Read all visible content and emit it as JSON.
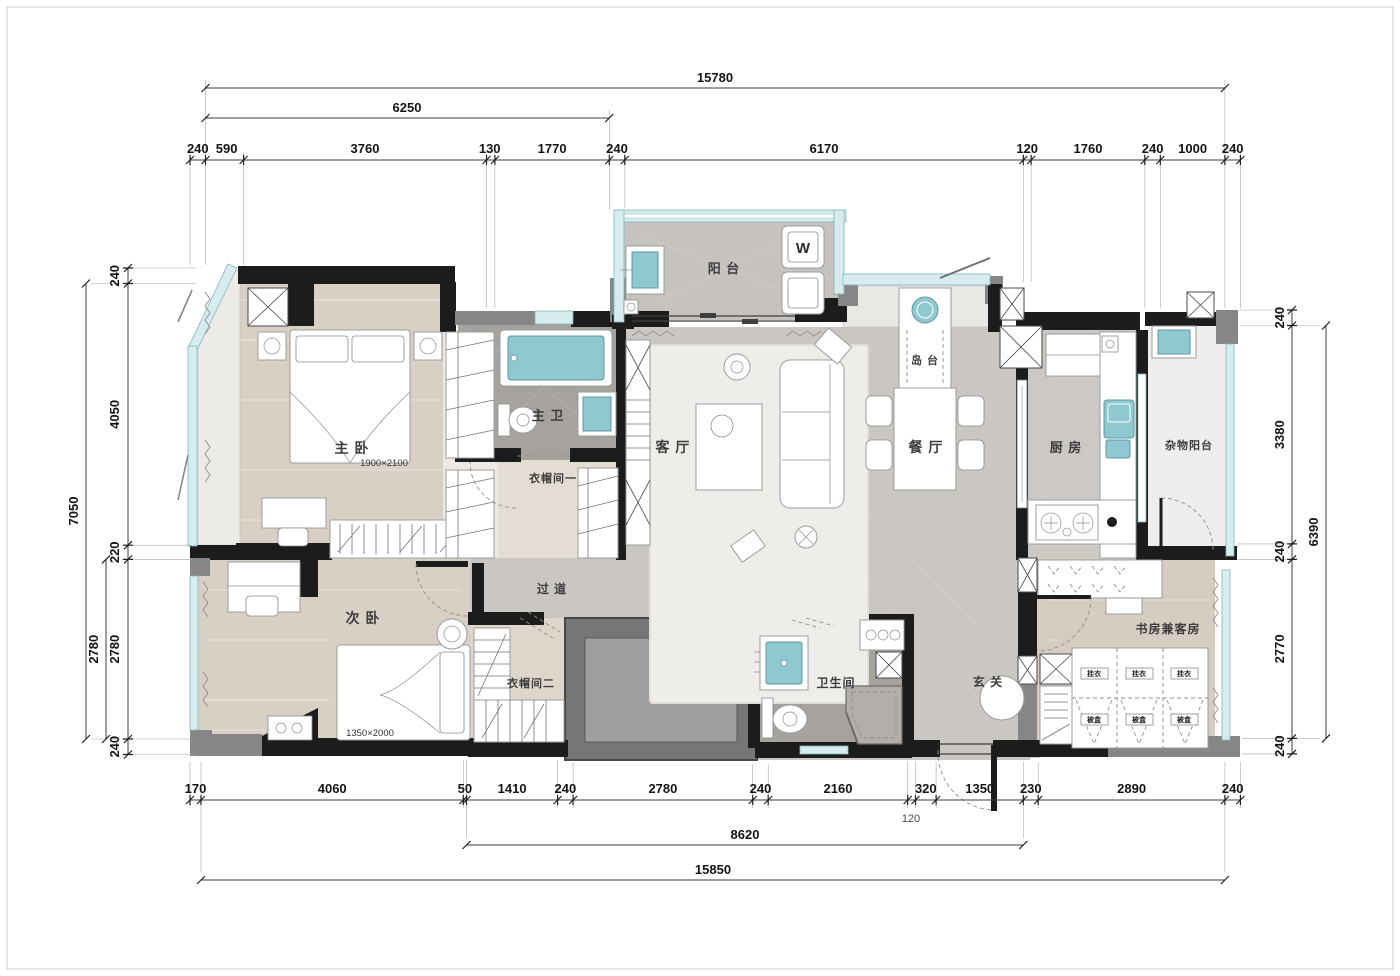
{
  "drawing": {
    "type": "apartment-floor-plan",
    "colors": {
      "wall_black": "#1c1c1c",
      "wall_gray": "#868686",
      "fixture_teal": "#8fc8d0",
      "glazing_teal": "#d7ecee",
      "wood_floor": "#d8cfc5",
      "marble_floor": "#cac6c1",
      "dark_marble_floor": "#a6a29d",
      "void_gray": "#767676"
    }
  },
  "rooms": {
    "master_bedroom": {
      "label": "主 卧",
      "bed_size": "1900×2100"
    },
    "second_bedroom": {
      "label": "次 卧",
      "bed_size": "1350×2000"
    },
    "master_bath": {
      "label": "主 卫"
    },
    "closet1": {
      "label": "衣帽间一"
    },
    "closet2": {
      "label": "衣帽间二"
    },
    "living": {
      "label": "客 厅"
    },
    "dining": {
      "label": "餐 厅"
    },
    "island": {
      "label": "岛 台"
    },
    "balcony": {
      "label": "阳 台"
    },
    "kitchen": {
      "label": "厨 房"
    },
    "utility_balcony": {
      "label": "杂物阳台"
    },
    "study": {
      "label": "书房兼客房"
    },
    "bathroom": {
      "label": "卫生间"
    },
    "entry": {
      "label": "玄 关"
    },
    "corridor": {
      "label": "过 道"
    },
    "washer": {
      "label": "W"
    },
    "wardrobe_cells": {
      "top": "挂衣",
      "bottom": "被盒"
    }
  },
  "dims": {
    "top_total": "15780",
    "top_sub": "6250",
    "top_chain": [
      "240",
      "590",
      "3760",
      "130",
      "1770",
      "240",
      "6170",
      "120",
      "1760",
      "240",
      "1000",
      "240"
    ],
    "bottom_chain": [
      "170",
      "4060",
      "50",
      "1410",
      "240",
      "2780",
      "240",
      "2160",
      "320",
      "1350",
      "230",
      "2890",
      "240"
    ],
    "bottom_offset": "120",
    "bottom_sub": "8620",
    "bottom_total": "15850",
    "left_chain": [
      "240",
      "4050",
      "220",
      "2780",
      "240"
    ],
    "left_sub": "2780",
    "left_total": "7050",
    "right_chain": [
      "240",
      "3380",
      "240",
      "2770",
      "240"
    ],
    "right_total": "6390"
  }
}
